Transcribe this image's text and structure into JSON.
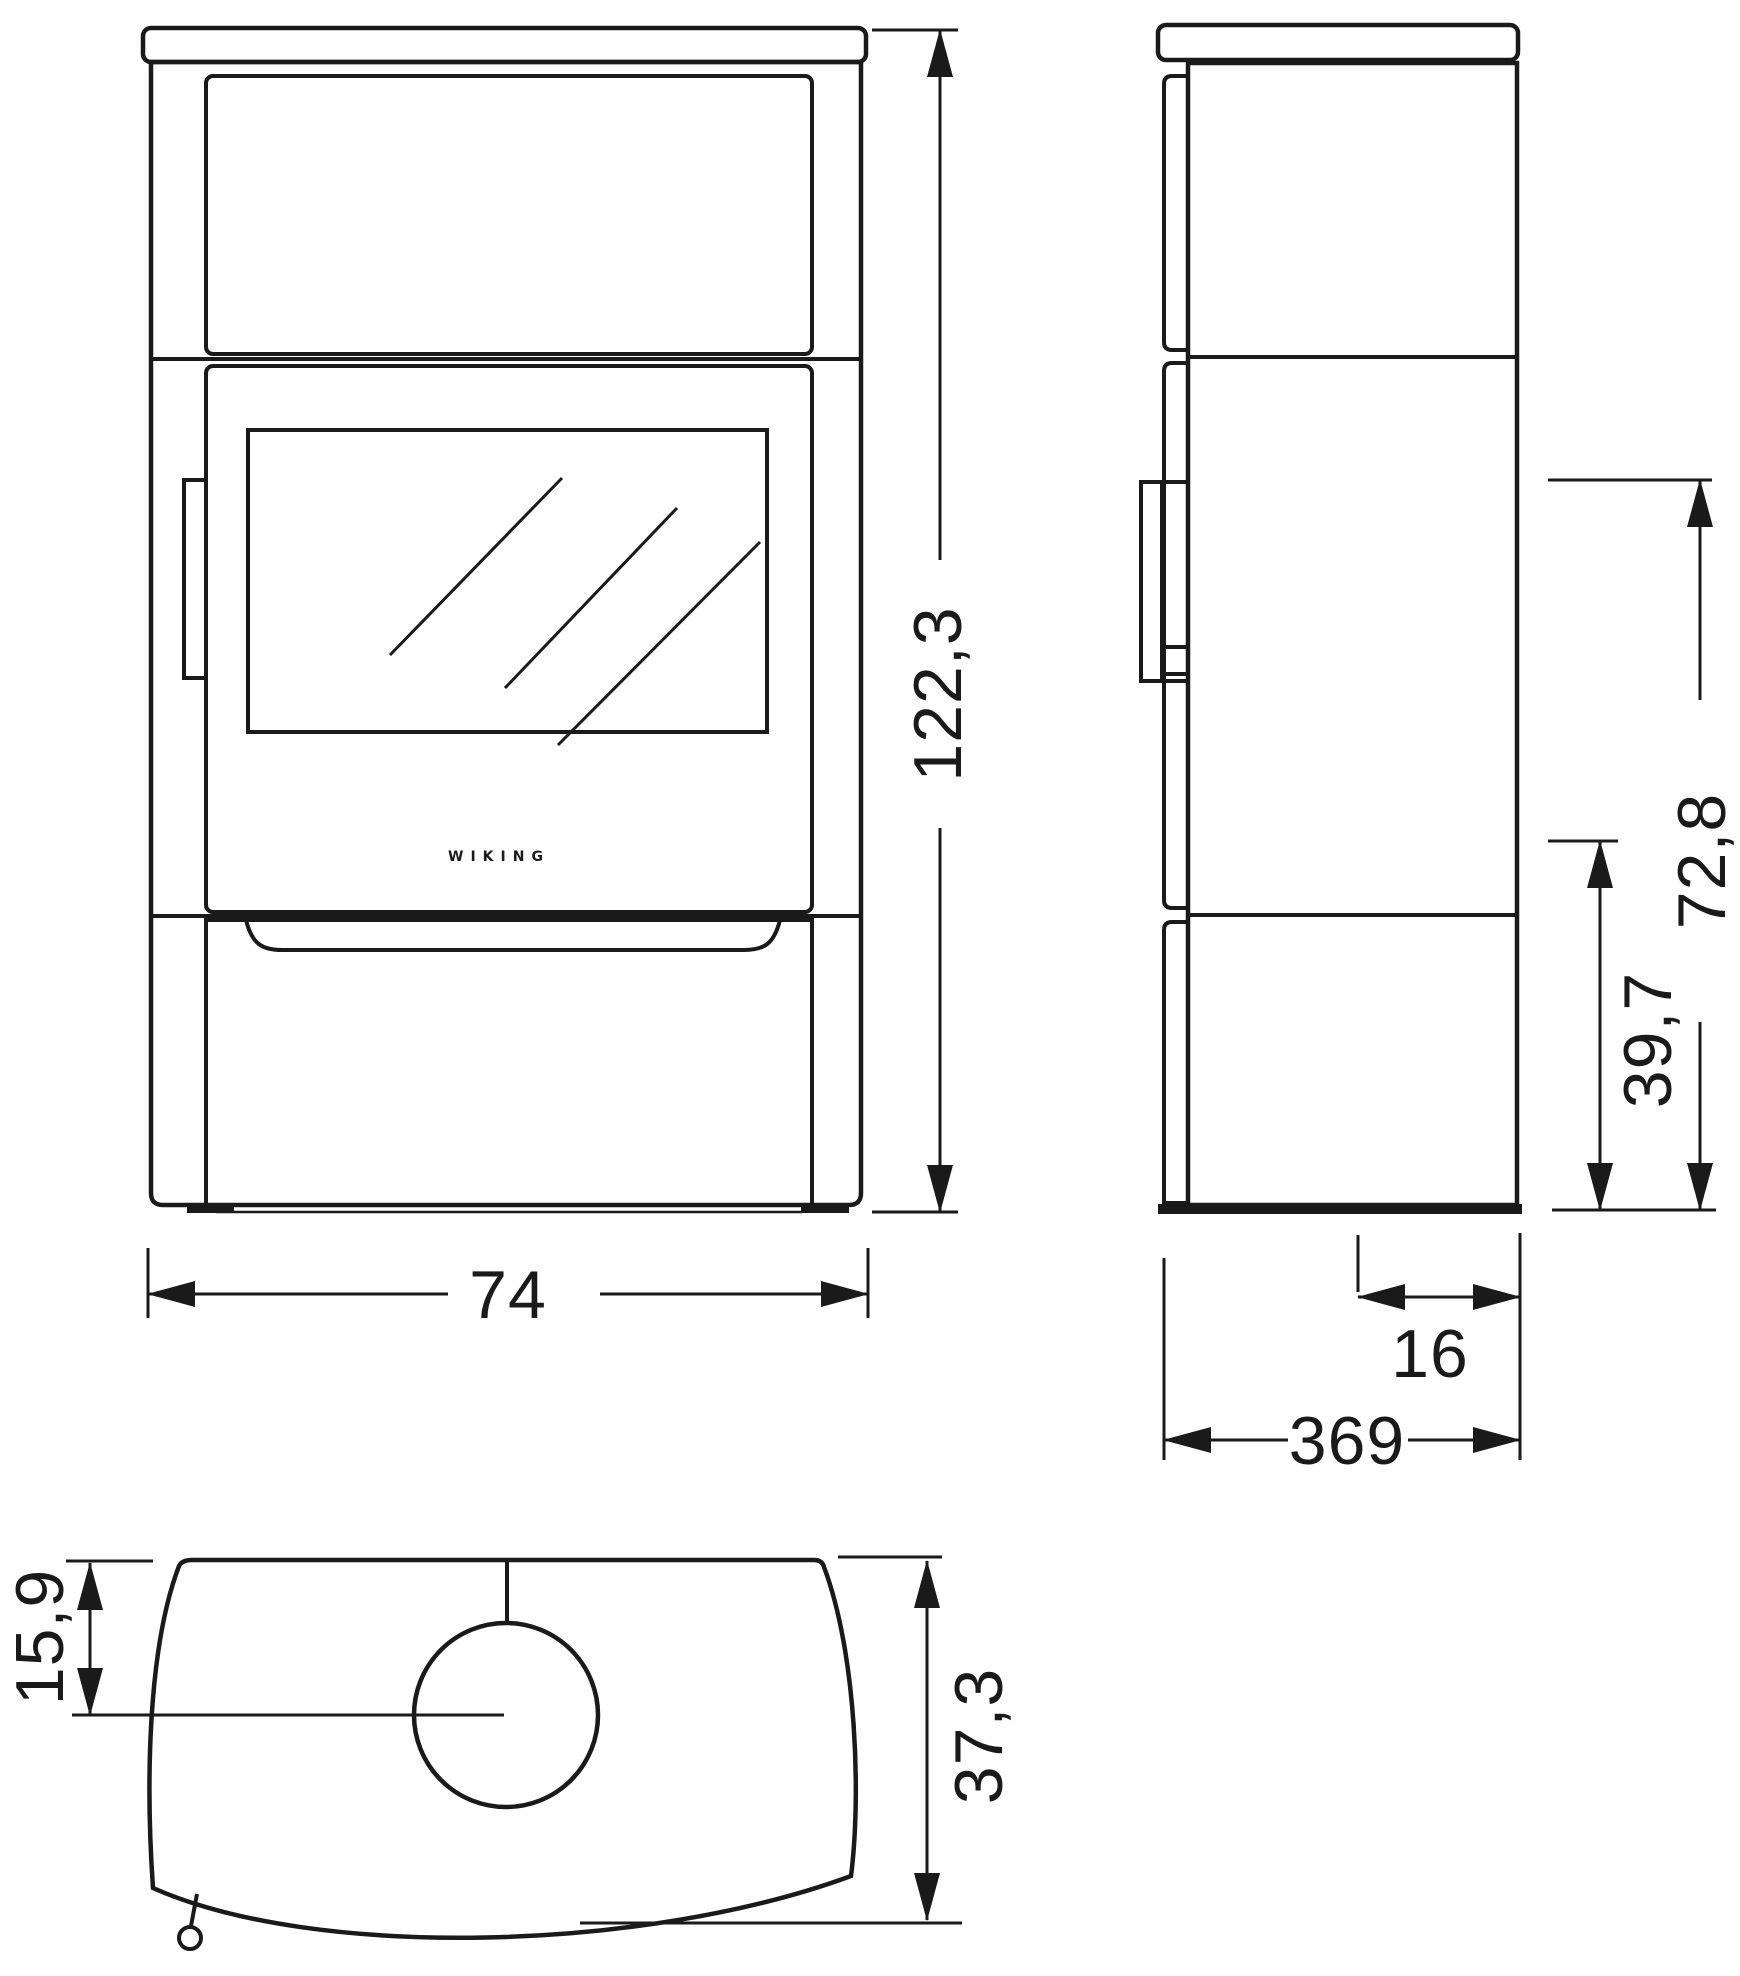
{
  "brand_label": "WIKING",
  "colors": {
    "line": "#1a1a1a",
    "background": "#ffffff"
  },
  "dimensions": {
    "front_height": "122,3",
    "front_width": "74",
    "side_upper_height": "72,8",
    "side_lower_height": "39,7",
    "side_flue_offset": "16",
    "side_depth": "369",
    "top_flue_offset": "15,9",
    "top_depth": "37,3"
  }
}
